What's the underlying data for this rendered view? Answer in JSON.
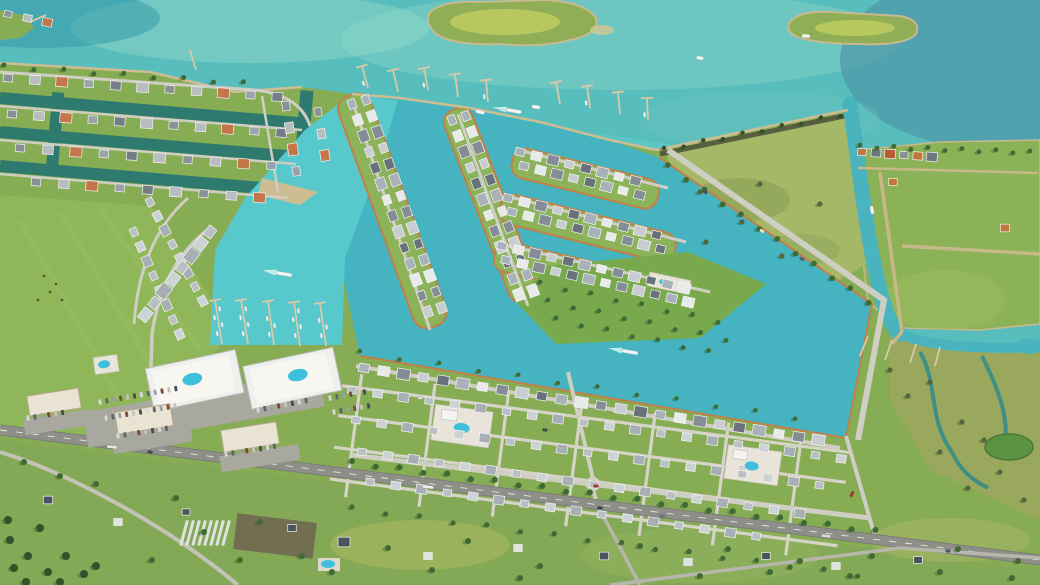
{
  "scene": {
    "description": "Oblique 3D aerial rendering of a coastal master-planned marina community: teal bay with two green islands at top, existing canal neighborhood at upper left, new canal-home district with marina basin, twin mid-rise condo building with rooftop pools, large green development parcel, cottage grid neighborhood, landscaped parkway, a highway running diagonally across the bottom, rural homesteads below it, and a scrub island with marsh creeks on the right",
    "type": "3d-aerial-render",
    "time_of_day": "day"
  },
  "palette": {
    "bay": "#58bdbd",
    "bay_deep": "#3e93a6",
    "bay_light": "#8fd8c8",
    "harbor": "#57c9cd",
    "canal": "#45b4c0",
    "canal_old": "#2e7a6e",
    "creek": "#3f8f85",
    "land": "#86ac54",
    "pasture": "#8fb65a",
    "field": "#79a94d",
    "scrub": "#a4b868",
    "marsh": "#9aa85e",
    "island_green": "#8fae56",
    "meadow": "#b9c75f",
    "sand": "#cdbd93",
    "seawall": "#c08048",
    "road": "#cfcec2",
    "highway": "#8e8f88",
    "dirt_road": "#c9b887",
    "dock": "#d9c9a4",
    "pool": "#3ec0dc",
    "building": "#eef0ee",
    "deck": "#f7f6f1",
    "retail": "#e9e3d3",
    "parking": "#a8a89e",
    "tree": "#3d6b33",
    "tree_dark": "#31512a",
    "shrub": "#55663c",
    "pond": "#5d9340",
    "roofs": {
      "mix": [
        "#8a9098",
        "#b8bdc2",
        "#c2764a",
        "#9aa3ab",
        "#757d85",
        "#b8bdc2"
      ],
      "mix2": [
        "#aab2b9",
        "#e8eaea",
        "#848d96",
        "#c8cdd1",
        "#69727b"
      ],
      "light": [
        "#b9bfc4",
        "#cdd2d6",
        "#a7aeb4"
      ],
      "island": [
        "#c2763f",
        "#6e7880",
        "#b65c33",
        "#8a9098"
      ],
      "dark": [
        "#4a545e"
      ],
      "white": [
        "#dfe3e4"
      ]
    },
    "car_colors": [
      "#d6d8d9",
      "#5d666e",
      "#9aa1a7",
      "#7d4a3a",
      "#c7c2b8",
      "#434c55"
    ]
  },
  "render": {
    "house_rows": [
      {
        "x": 8,
        "y": 14,
        "angle": 12,
        "gap": 20,
        "count": 3,
        "size": 9,
        "roof": "mix"
      },
      {
        "x": 8,
        "y": 78,
        "angle": 4,
        "gap": 27,
        "count": 11,
        "size": 11,
        "roof": "mix"
      },
      {
        "x": 12,
        "y": 114,
        "angle": 4,
        "gap": 27,
        "count": 11,
        "size": 11,
        "roof": "mix"
      },
      {
        "x": 20,
        "y": 148,
        "angle": 4,
        "gap": 28,
        "count": 10,
        "size": 11,
        "roof": "mix"
      },
      {
        "x": 36,
        "y": 182,
        "angle": 4,
        "gap": 28,
        "count": 9,
        "size": 11,
        "roof": "mix"
      },
      {
        "x": 286,
        "y": 106,
        "angle": 81,
        "gap": 22,
        "count": 4,
        "size": 11,
        "roof": "mix"
      },
      {
        "x": 318,
        "y": 112,
        "angle": 81,
        "gap": 22,
        "count": 3,
        "size": 10,
        "roof": "mix"
      },
      {
        "x": 150,
        "y": 202,
        "angle": 62,
        "gap": 16,
        "count": 8,
        "size": 10,
        "roof": "light"
      },
      {
        "x": 134,
        "y": 232,
        "angle": 66,
        "gap": 16,
        "count": 8,
        "size": 10,
        "roof": "light"
      },
      {
        "x": 210,
        "y": 232,
        "angle": 128,
        "gap": 15,
        "count": 8,
        "size": 13,
        "roof": "light"
      },
      {
        "x": 352,
        "y": 104,
        "angle": 70,
        "gap": 17,
        "count": 14,
        "size": 11,
        "roof": "mix2"
      },
      {
        "x": 366,
        "y": 100,
        "angle": 70,
        "gap": 17,
        "count": 14,
        "size": 11,
        "roof": "mix2"
      },
      {
        "x": 452,
        "y": 120,
        "angle": 69,
        "gap": 17,
        "count": 12,
        "size": 11,
        "roof": "mix2"
      },
      {
        "x": 466,
        "y": 116,
        "angle": 69,
        "gap": 17,
        "count": 12,
        "size": 11,
        "roof": "mix2"
      },
      {
        "x": 520,
        "y": 152,
        "angle": 14,
        "gap": 17,
        "count": 8,
        "size": 11,
        "roof": "mix2"
      },
      {
        "x": 524,
        "y": 166,
        "angle": 14,
        "gap": 17,
        "count": 8,
        "size": 11,
        "roof": "mix2"
      },
      {
        "x": 508,
        "y": 198,
        "angle": 14,
        "gap": 17,
        "count": 10,
        "size": 11,
        "roof": "mix2"
      },
      {
        "x": 512,
        "y": 212,
        "angle": 14,
        "gap": 17,
        "count": 10,
        "size": 11,
        "roof": "mix2"
      },
      {
        "x": 502,
        "y": 246,
        "angle": 13,
        "gap": 17,
        "count": 12,
        "size": 11,
        "roof": "mix2"
      },
      {
        "x": 506,
        "y": 260,
        "angle": 13,
        "gap": 17,
        "count": 12,
        "size": 11,
        "roof": "mix2"
      },
      {
        "x": 364,
        "y": 368,
        "angle": 9,
        "gap": 20,
        "count": 24,
        "size": 12,
        "roof": "mix2"
      },
      {
        "x": 352,
        "y": 390,
        "angle": 8,
        "gap": 26,
        "count": 20,
        "size": 10,
        "roof": "light"
      },
      {
        "x": 356,
        "y": 420,
        "angle": 8,
        "gap": 26,
        "count": 19,
        "size": 10,
        "roof": "light"
      },
      {
        "x": 362,
        "y": 452,
        "angle": 8,
        "gap": 26,
        "count": 18,
        "size": 10,
        "roof": "light"
      },
      {
        "x": 370,
        "y": 482,
        "angle": 8,
        "gap": 26,
        "count": 16,
        "size": 10,
        "roof": "light"
      },
      {
        "x": 862,
        "y": 152,
        "angle": 4,
        "gap": 14,
        "count": 6,
        "size": 10,
        "roof": "island"
      },
      {
        "x": 893,
        "y": 182,
        "angle": 0,
        "gap": 12,
        "count": 1,
        "size": 10,
        "roof": "island"
      },
      {
        "x": 1005,
        "y": 228,
        "angle": 0,
        "gap": 12,
        "count": 1,
        "size": 11,
        "roof": "island"
      },
      {
        "x": 48,
        "y": 500,
        "angle": 0,
        "gap": 12,
        "count": 1,
        "size": 11,
        "roof": "dark"
      },
      {
        "x": 118,
        "y": 522,
        "angle": 0,
        "gap": 12,
        "count": 1,
        "size": 10,
        "roof": "white"
      },
      {
        "x": 186,
        "y": 512,
        "angle": 0,
        "gap": 12,
        "count": 1,
        "size": 9,
        "roof": "dark"
      },
      {
        "x": 292,
        "y": 528,
        "angle": 0,
        "gap": 12,
        "count": 1,
        "size": 10,
        "roof": "dark"
      },
      {
        "x": 344,
        "y": 542,
        "angle": 0,
        "gap": 12,
        "count": 1,
        "size": 14,
        "roof": "dark"
      },
      {
        "x": 428,
        "y": 556,
        "angle": 0,
        "gap": 12,
        "count": 1,
        "size": 10,
        "roof": "white"
      },
      {
        "x": 518,
        "y": 548,
        "angle": 0,
        "gap": 12,
        "count": 1,
        "size": 10,
        "roof": "white"
      },
      {
        "x": 604,
        "y": 556,
        "angle": 0,
        "gap": 12,
        "count": 1,
        "size": 11,
        "roof": "dark"
      },
      {
        "x": 688,
        "y": 562,
        "angle": 0,
        "gap": 12,
        "count": 1,
        "size": 10,
        "roof": "white"
      },
      {
        "x": 766,
        "y": 556,
        "angle": 0,
        "gap": 12,
        "count": 1,
        "size": 10,
        "roof": "dark"
      },
      {
        "x": 836,
        "y": 566,
        "angle": 0,
        "gap": 12,
        "count": 1,
        "size": 10,
        "roof": "white"
      },
      {
        "x": 918,
        "y": 560,
        "angle": 0,
        "gap": 12,
        "count": 1,
        "size": 10,
        "roof": "dark"
      }
    ],
    "tree_rows": [
      {
        "x": 4,
        "y": 66,
        "angle": 4,
        "gap": 30,
        "count": 9,
        "r": 2.5
      },
      {
        "x": 352,
        "y": 462,
        "angle": 7.5,
        "gap": 24,
        "count": 23,
        "r": 3
      },
      {
        "x": 352,
        "y": 508,
        "angle": 7.5,
        "gap": 34,
        "count": 16,
        "r": 2.6
      },
      {
        "x": 668,
        "y": 166,
        "angle": 34,
        "gap": 22,
        "count": 12,
        "r": 2.8
      },
      {
        "x": 540,
        "y": 283,
        "angle": 12,
        "gap": 26,
        "count": 8,
        "r": 2.4
      },
      {
        "x": 548,
        "y": 301,
        "angle": 12,
        "gap": 26,
        "count": 8,
        "r": 2.4
      },
      {
        "x": 556,
        "y": 319,
        "angle": 12,
        "gap": 26,
        "count": 7,
        "r": 2.4
      },
      {
        "x": 860,
        "y": 146,
        "angle": 2,
        "gap": 17,
        "count": 11,
        "r": 2.4
      },
      {
        "x": 664,
        "y": 149,
        "angle": -11,
        "gap": 20,
        "count": 10,
        "r": 2.2,
        "c": "#31512a"
      },
      {
        "x": 360,
        "y": 352,
        "angle": 8.5,
        "gap": 40,
        "count": 12,
        "r": 2.2
      }
    ],
    "tree_scatter": [
      [
        260,
        522
      ],
      [
        302,
        556
      ],
      [
        388,
        548
      ],
      [
        468,
        541
      ],
      [
        540,
        566
      ],
      [
        640,
        546
      ],
      [
        728,
        549
      ],
      [
        800,
        561
      ],
      [
        872,
        556
      ],
      [
        958,
        549
      ],
      [
        1018,
        561
      ],
      [
        152,
        560
      ],
      [
        204,
        532
      ],
      [
        332,
        572
      ],
      [
        432,
        570
      ],
      [
        520,
        578
      ],
      [
        96,
        484
      ],
      [
        60,
        476
      ],
      [
        24,
        462
      ],
      [
        176,
        498
      ],
      [
        240,
        560
      ],
      [
        700,
        576
      ],
      [
        770,
        572
      ],
      [
        850,
        576
      ],
      [
        940,
        572
      ],
      [
        1012,
        578
      ]
    ],
    "tree_cluster_dark": [
      [
        10,
        540
      ],
      [
        28,
        556
      ],
      [
        48,
        572
      ],
      [
        14,
        568
      ],
      [
        66,
        556
      ],
      [
        40,
        528
      ],
      [
        84,
        574
      ],
      [
        8,
        520
      ],
      [
        96,
        566
      ],
      [
        26,
        582
      ],
      [
        60,
        582
      ]
    ],
    "shrub_scatter": [
      [
        700,
        192
      ],
      [
        742,
        222
      ],
      [
        782,
        256
      ],
      [
        820,
        204
      ],
      [
        706,
        242
      ],
      [
        760,
        184
      ],
      [
        930,
        382
      ],
      [
        962,
        422
      ],
      [
        1000,
        472
      ],
      [
        940,
        452
      ],
      [
        908,
        396
      ],
      [
        890,
        370
      ],
      [
        984,
        440
      ],
      [
        1024,
        500
      ],
      [
        968,
        488
      ]
    ],
    "livestock": [
      [
        44,
        276
      ],
      [
        56,
        284
      ],
      [
        50,
        292
      ],
      [
        38,
        300
      ],
      [
        62,
        300
      ]
    ],
    "piers": [
      {
        "x": 368,
        "y": 88,
        "x2": 362,
        "y2": 66,
        "cap": true,
        "boats": 1
      },
      {
        "x": 398,
        "y": 92,
        "x2": 393,
        "y2": 70,
        "cap": true,
        "boats": 0
      },
      {
        "x": 428,
        "y": 90,
        "x2": 424,
        "y2": 68,
        "cap": true,
        "boats": 1
      },
      {
        "x": 458,
        "y": 97,
        "x2": 455,
        "y2": 74,
        "cap": true,
        "boats": 0
      },
      {
        "x": 488,
        "y": 102,
        "x2": 486,
        "y2": 80,
        "cap": true,
        "boats": 1
      },
      {
        "x": 560,
        "y": 104,
        "x2": 556,
        "y2": 82,
        "cap": true,
        "boats": 0
      },
      {
        "x": 590,
        "y": 108,
        "x2": 587,
        "y2": 86,
        "cap": true,
        "boats": 1
      },
      {
        "x": 620,
        "y": 114,
        "x2": 618,
        "y2": 92,
        "cap": true,
        "boats": 0
      },
      {
        "x": 648,
        "y": 120,
        "x2": 647,
        "y2": 98,
        "cap": true,
        "boats": 1
      },
      {
        "x": 196,
        "y": 70,
        "x2": 190,
        "y2": 50,
        "cap": false,
        "boats": 0
      },
      {
        "x": 30,
        "y": 22,
        "x2": 46,
        "y2": 15,
        "cap": false,
        "boats": 0
      },
      {
        "x": 868,
        "y": 336,
        "x2": 860,
        "y2": 356,
        "cap": false,
        "boats": 0
      },
      {
        "x": 892,
        "y": 340,
        "x2": 885,
        "y2": 360,
        "cap": false,
        "boats": 0
      },
      {
        "x": 916,
        "y": 344,
        "x2": 910,
        "y2": 363,
        "cap": false,
        "boats": 0
      },
      {
        "x": 940,
        "y": 347,
        "x2": 935,
        "y2": 366,
        "cap": false,
        "boats": 0
      },
      {
        "x": 222,
        "y": 344,
        "x2": 215,
        "y2": 300,
        "cap": true,
        "boats": 4
      },
      {
        "x": 248,
        "y": 344,
        "x2": 241,
        "y2": 300,
        "cap": true,
        "boats": 4
      },
      {
        "x": 274,
        "y": 345,
        "x2": 268,
        "y2": 301,
        "cap": true,
        "boats": 3
      },
      {
        "x": 300,
        "y": 346,
        "x2": 294,
        "y2": 302,
        "cap": true,
        "boats": 4
      },
      {
        "x": 326,
        "y": 346,
        "x2": 320,
        "y2": 303,
        "cap": true,
        "boats": 3
      }
    ],
    "boats": [
      {
        "x": 480,
        "y": 112,
        "a": 14,
        "l": 9,
        "wake": false
      },
      {
        "x": 514,
        "y": 111,
        "a": 10,
        "l": 15,
        "wake": true
      },
      {
        "x": 536,
        "y": 107,
        "a": 8,
        "l": 8,
        "wake": false
      },
      {
        "x": 806,
        "y": 36,
        "a": 4,
        "l": 8,
        "wake": false
      },
      {
        "x": 700,
        "y": 58,
        "a": 10,
        "l": 7,
        "wake": false
      },
      {
        "x": 284,
        "y": 274,
        "a": 10,
        "l": 16,
        "wake": true
      },
      {
        "x": 630,
        "y": 352,
        "a": 10,
        "l": 16,
        "wake": true
      },
      {
        "x": 872,
        "y": 210,
        "a": 80,
        "l": 8,
        "wake": false
      }
    ],
    "cars": [
      {
        "x": 112,
        "y": 447,
        "a": 7,
        "l": 10,
        "c": "#e8e8e6"
      },
      {
        "x": 150,
        "y": 452,
        "a": 7,
        "l": 5,
        "c": "#454e57"
      },
      {
        "x": 428,
        "y": 487,
        "a": 7,
        "l": 11,
        "c": "#ececea"
      },
      {
        "x": 600,
        "y": 508,
        "a": 7,
        "l": 5,
        "c": "#3c444d"
      },
      {
        "x": 662,
        "y": 516,
        "a": 7,
        "l": 5,
        "c": "#6d7680"
      },
      {
        "x": 826,
        "y": 536,
        "a": 7,
        "l": 9,
        "c": "#dcdcda"
      },
      {
        "x": 948,
        "y": 551,
        "a": 7,
        "l": 5,
        "c": "#50585f"
      },
      {
        "x": 596,
        "y": 486,
        "a": 0,
        "l": 5,
        "c": "#b03a2a"
      },
      {
        "x": 852,
        "y": 494,
        "a": -68,
        "l": 6,
        "c": "#a33b2e"
      },
      {
        "x": 705,
        "y": 192,
        "a": 34,
        "l": 5,
        "c": "#49525c"
      },
      {
        "x": 762,
        "y": 231,
        "a": 34,
        "l": 5,
        "c": "#e6e6e3"
      },
      {
        "x": 802,
        "y": 259,
        "a": 34,
        "l": 5,
        "c": "#555e66"
      },
      {
        "x": 420,
        "y": 398,
        "a": 8,
        "l": 5,
        "c": "#d9dadb"
      },
      {
        "x": 545,
        "y": 430,
        "a": 8,
        "l": 5,
        "c": "#434c55"
      },
      {
        "x": 742,
        "y": 468,
        "a": 8,
        "l": 5,
        "c": "#cfd1d2"
      }
    ],
    "parking_rows": [
      {
        "x": 100,
        "y": 402,
        "a": -10,
        "count": 12,
        "gap": 7
      },
      {
        "x": 106,
        "y": 418,
        "a": -10,
        "count": 11,
        "gap": 7
      },
      {
        "x": 330,
        "y": 398,
        "a": -10,
        "count": 6,
        "gap": 7
      },
      {
        "x": 334,
        "y": 412,
        "a": -10,
        "count": 6,
        "gap": 7
      },
      {
        "x": 28,
        "y": 418,
        "a": -9,
        "count": 6,
        "gap": 7
      },
      {
        "x": 118,
        "y": 436,
        "a": -9,
        "count": 8,
        "gap": 7
      },
      {
        "x": 226,
        "y": 454,
        "a": -9,
        "count": 8,
        "gap": 7
      },
      {
        "x": 258,
        "y": 410,
        "a": -11,
        "count": 8,
        "gap": 7
      }
    ],
    "strip_rows": [
      {
        "x": 186,
        "y": 520,
        "count": 8,
        "gap": 6,
        "w": 3,
        "h": 26,
        "rot": 15,
        "fill": "#dfe3df"
      }
    ]
  }
}
